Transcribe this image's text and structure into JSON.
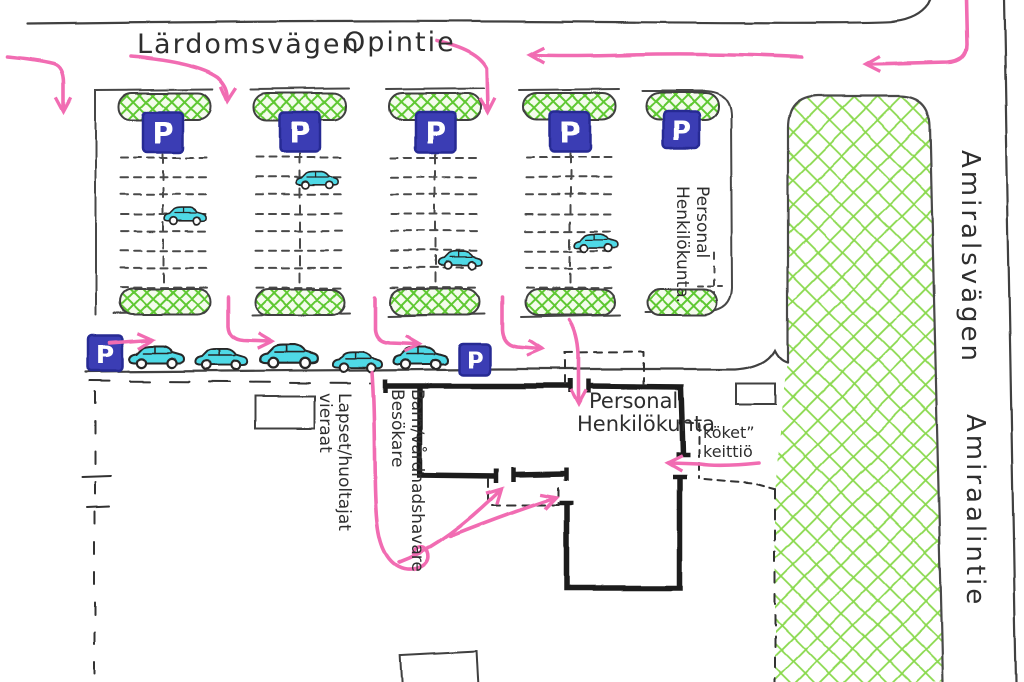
{
  "map": {
    "streets": {
      "top_left": "Lärdomsvägen",
      "top_right": "Opintie",
      "right_upper": "Amiralsvägen",
      "right_lower": "Amiraalintie"
    },
    "labels": {
      "staff_parking_column": {
        "line1": "Personal",
        "line2": "Henkilökunta."
      },
      "staff_entrance": {
        "line1": "Personal",
        "line2": "Henkilökunta"
      },
      "kitchen": {
        "line1": "köket”",
        "line2": "keittiö"
      },
      "children_guardians_fi": {
        "line1": "Lapset/huoltajat",
        "line2": "vieraat"
      },
      "children_guardians_sv": {
        "line1": "Barn/vårdnadshavare",
        "line2": "Besökare"
      }
    },
    "signs": {
      "parking_letter": "P"
    }
  },
  "colors": {
    "route_pink": "#f16cb2",
    "sign_blue": "#3a3db4",
    "sign_blue_dark": "#282b93",
    "car_cyan": "#4fd9e6",
    "hedge_green": "#5ec832",
    "field_green": "#8ad94e",
    "ink": "#3f3f3f",
    "wall_black": "#1d1d1d"
  }
}
